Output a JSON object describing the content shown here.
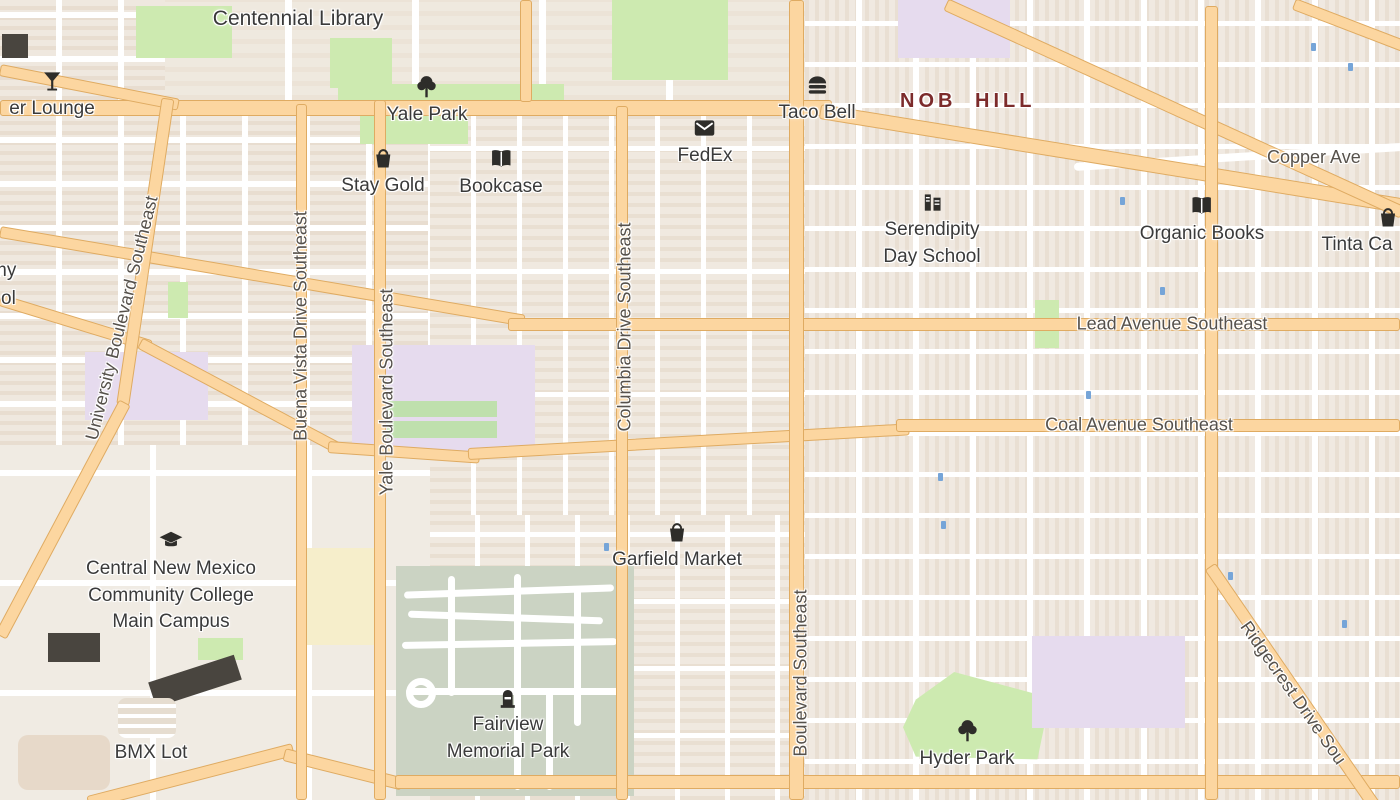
{
  "map": {
    "neighborhood": {
      "label": "NOB HILL"
    },
    "pois": [
      {
        "label": "Centennial Library",
        "icon": null
      },
      {
        "label": "er Lounge",
        "icon": "cocktail-glass"
      },
      {
        "label": "Yale Park",
        "icon": "tree"
      },
      {
        "label": "Stay Gold",
        "icon": "shopping-basket"
      },
      {
        "label": "Bookcase",
        "icon": "open-book"
      },
      {
        "label": "FedEx",
        "icon": "mail-envelope"
      },
      {
        "label": "Taco Bell",
        "icon": "burger"
      },
      {
        "label": "Serendipity\nDay School",
        "icon": "school-building"
      },
      {
        "label": "Organic Books",
        "icon": "open-book"
      },
      {
        "label": "Tinta Ca",
        "icon": "shopping-basket"
      },
      {
        "label": "Garfield Market",
        "icon": "shopping-basket"
      },
      {
        "label": "Central New Mexico\nCommunity College\nMain Campus",
        "icon": "graduation-cap"
      },
      {
        "label": "BMX Lot",
        "icon": null
      },
      {
        "label": "Fairview\nMemorial Park",
        "icon": "memorial-stone"
      },
      {
        "label": "Hyder Park",
        "icon": "tree"
      },
      {
        "label": "my",
        "icon": null
      },
      {
        "label": "ol",
        "icon": null
      }
    ],
    "street_labels": [
      {
        "label": "University Boulevard Southeast"
      },
      {
        "label": "Buena Vista Drive Southeast"
      },
      {
        "label": "Yale Boulevard Southeast"
      },
      {
        "label": "Columbia Drive Southeast"
      },
      {
        "label": "Boulevard Southeast"
      },
      {
        "label": "Lead Avenue Southeast"
      },
      {
        "label": "Coal Avenue Southeast"
      },
      {
        "label": "Copper Ave",
        "note": "clipped at right edge"
      },
      {
        "label": "Ridgecrest Drive Sou",
        "note": "clipped at bottom right"
      }
    ],
    "colors": {
      "background": "#f1ebe2",
      "major_road_fill": "#fcd6a0",
      "major_road_casing": "#dfab62",
      "minor_road": "#ffffff",
      "park_green": "#cdeab0",
      "cemetery_green": "#cbd3c3",
      "school_lavender": "#e6dbee",
      "campus_yellow": "#f6eecb",
      "pool_blue": "#76a5d8",
      "poi_text": "#3a3a3a",
      "road_label_text": "#56514b",
      "neighborhood_text": "#7c2b2b"
    }
  }
}
